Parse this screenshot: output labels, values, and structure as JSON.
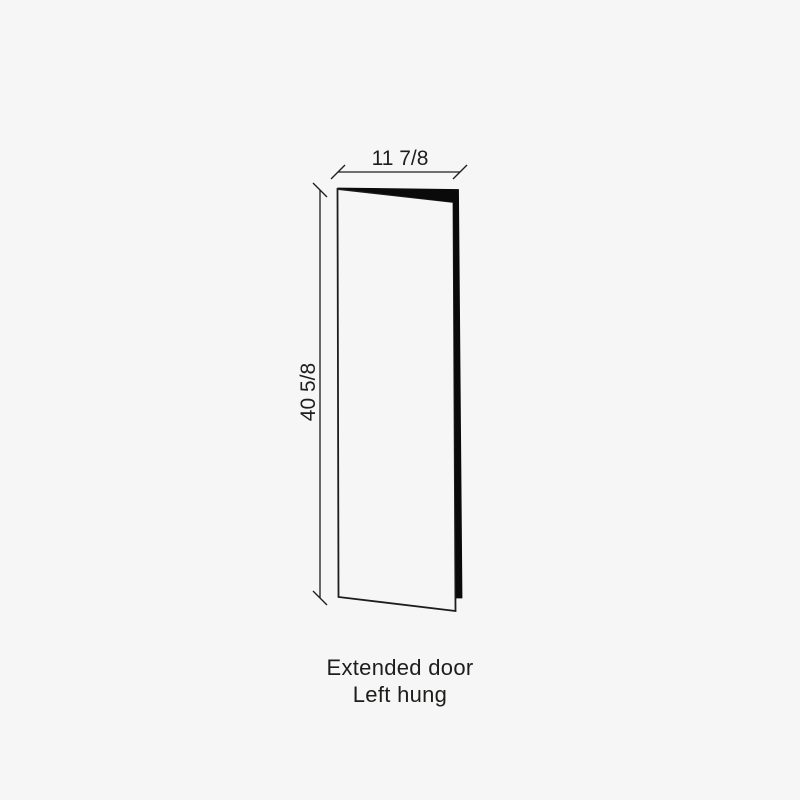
{
  "figure": {
    "type": "door-dimension-diagram",
    "width_label": "11 7/8",
    "height_label": "40 5/8",
    "caption_line1": "Extended door",
    "caption_line2": "Left hung"
  },
  "colors": {
    "background": "#f6f6f6",
    "line": "#1d1d1b",
    "door_edge_fill": "#0a0a0a",
    "text": "#1d1d1b"
  }
}
